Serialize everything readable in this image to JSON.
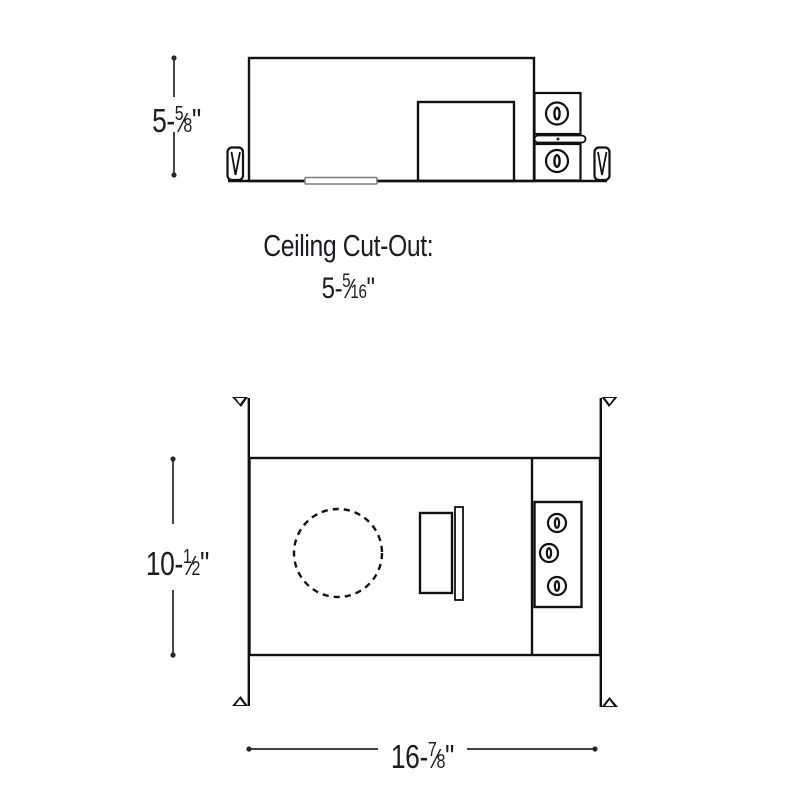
{
  "colors": {
    "line": "#111111",
    "text": "#1c1c26",
    "dim": "#26262e",
    "slot": "#7d7d7d"
  },
  "side_view": {
    "height_dim": {
      "prefix": "5-",
      "num": "5",
      "slash": "⁄",
      "den": "8",
      "suffix": "\""
    }
  },
  "cutout": {
    "title": "Ceiling Cut-Out:",
    "dim": {
      "prefix": "5-",
      "num": "5",
      "slash": "⁄",
      "den": "16",
      "suffix": "\""
    }
  },
  "plan_view": {
    "height_dim": {
      "prefix": "10-",
      "num": "1",
      "slash": "⁄",
      "den": "2",
      "suffix": "\""
    },
    "width_dim": {
      "prefix": "16-",
      "num": "7",
      "slash": "⁄",
      "den": "8",
      "suffix": "\""
    }
  }
}
